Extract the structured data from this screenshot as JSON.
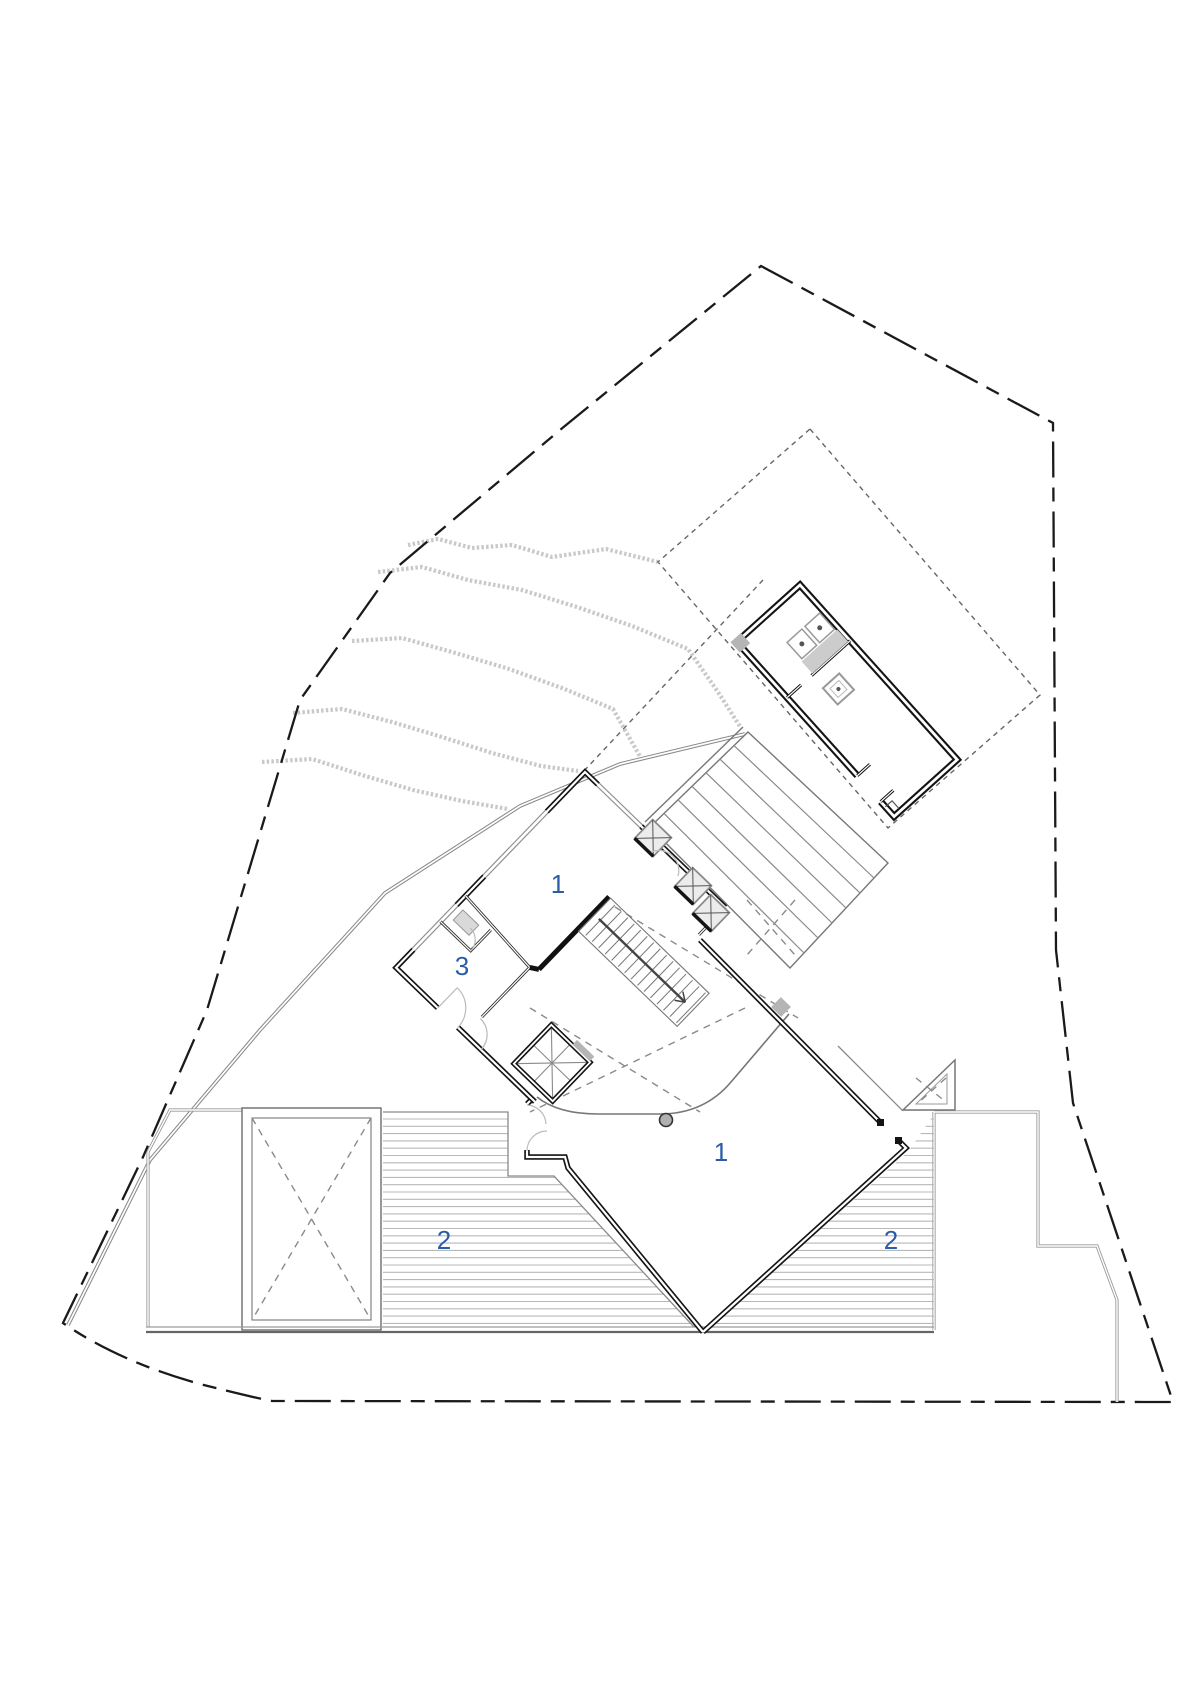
{
  "drawing": {
    "type": "architectural-site-floor-plan",
    "labels": {
      "room_upper_1": "1",
      "room_3": "3",
      "room_lower_1": "1",
      "deck_left_2": "2",
      "deck_right_2": "2"
    },
    "colors": {
      "label_blue": "#2b5ca8",
      "wall_black": "#141414",
      "line_gray": "#8a8a8a",
      "contour_gray": "#c9c9c9",
      "poche_gray": "#b5b5b5",
      "background": "#ffffff"
    }
  }
}
